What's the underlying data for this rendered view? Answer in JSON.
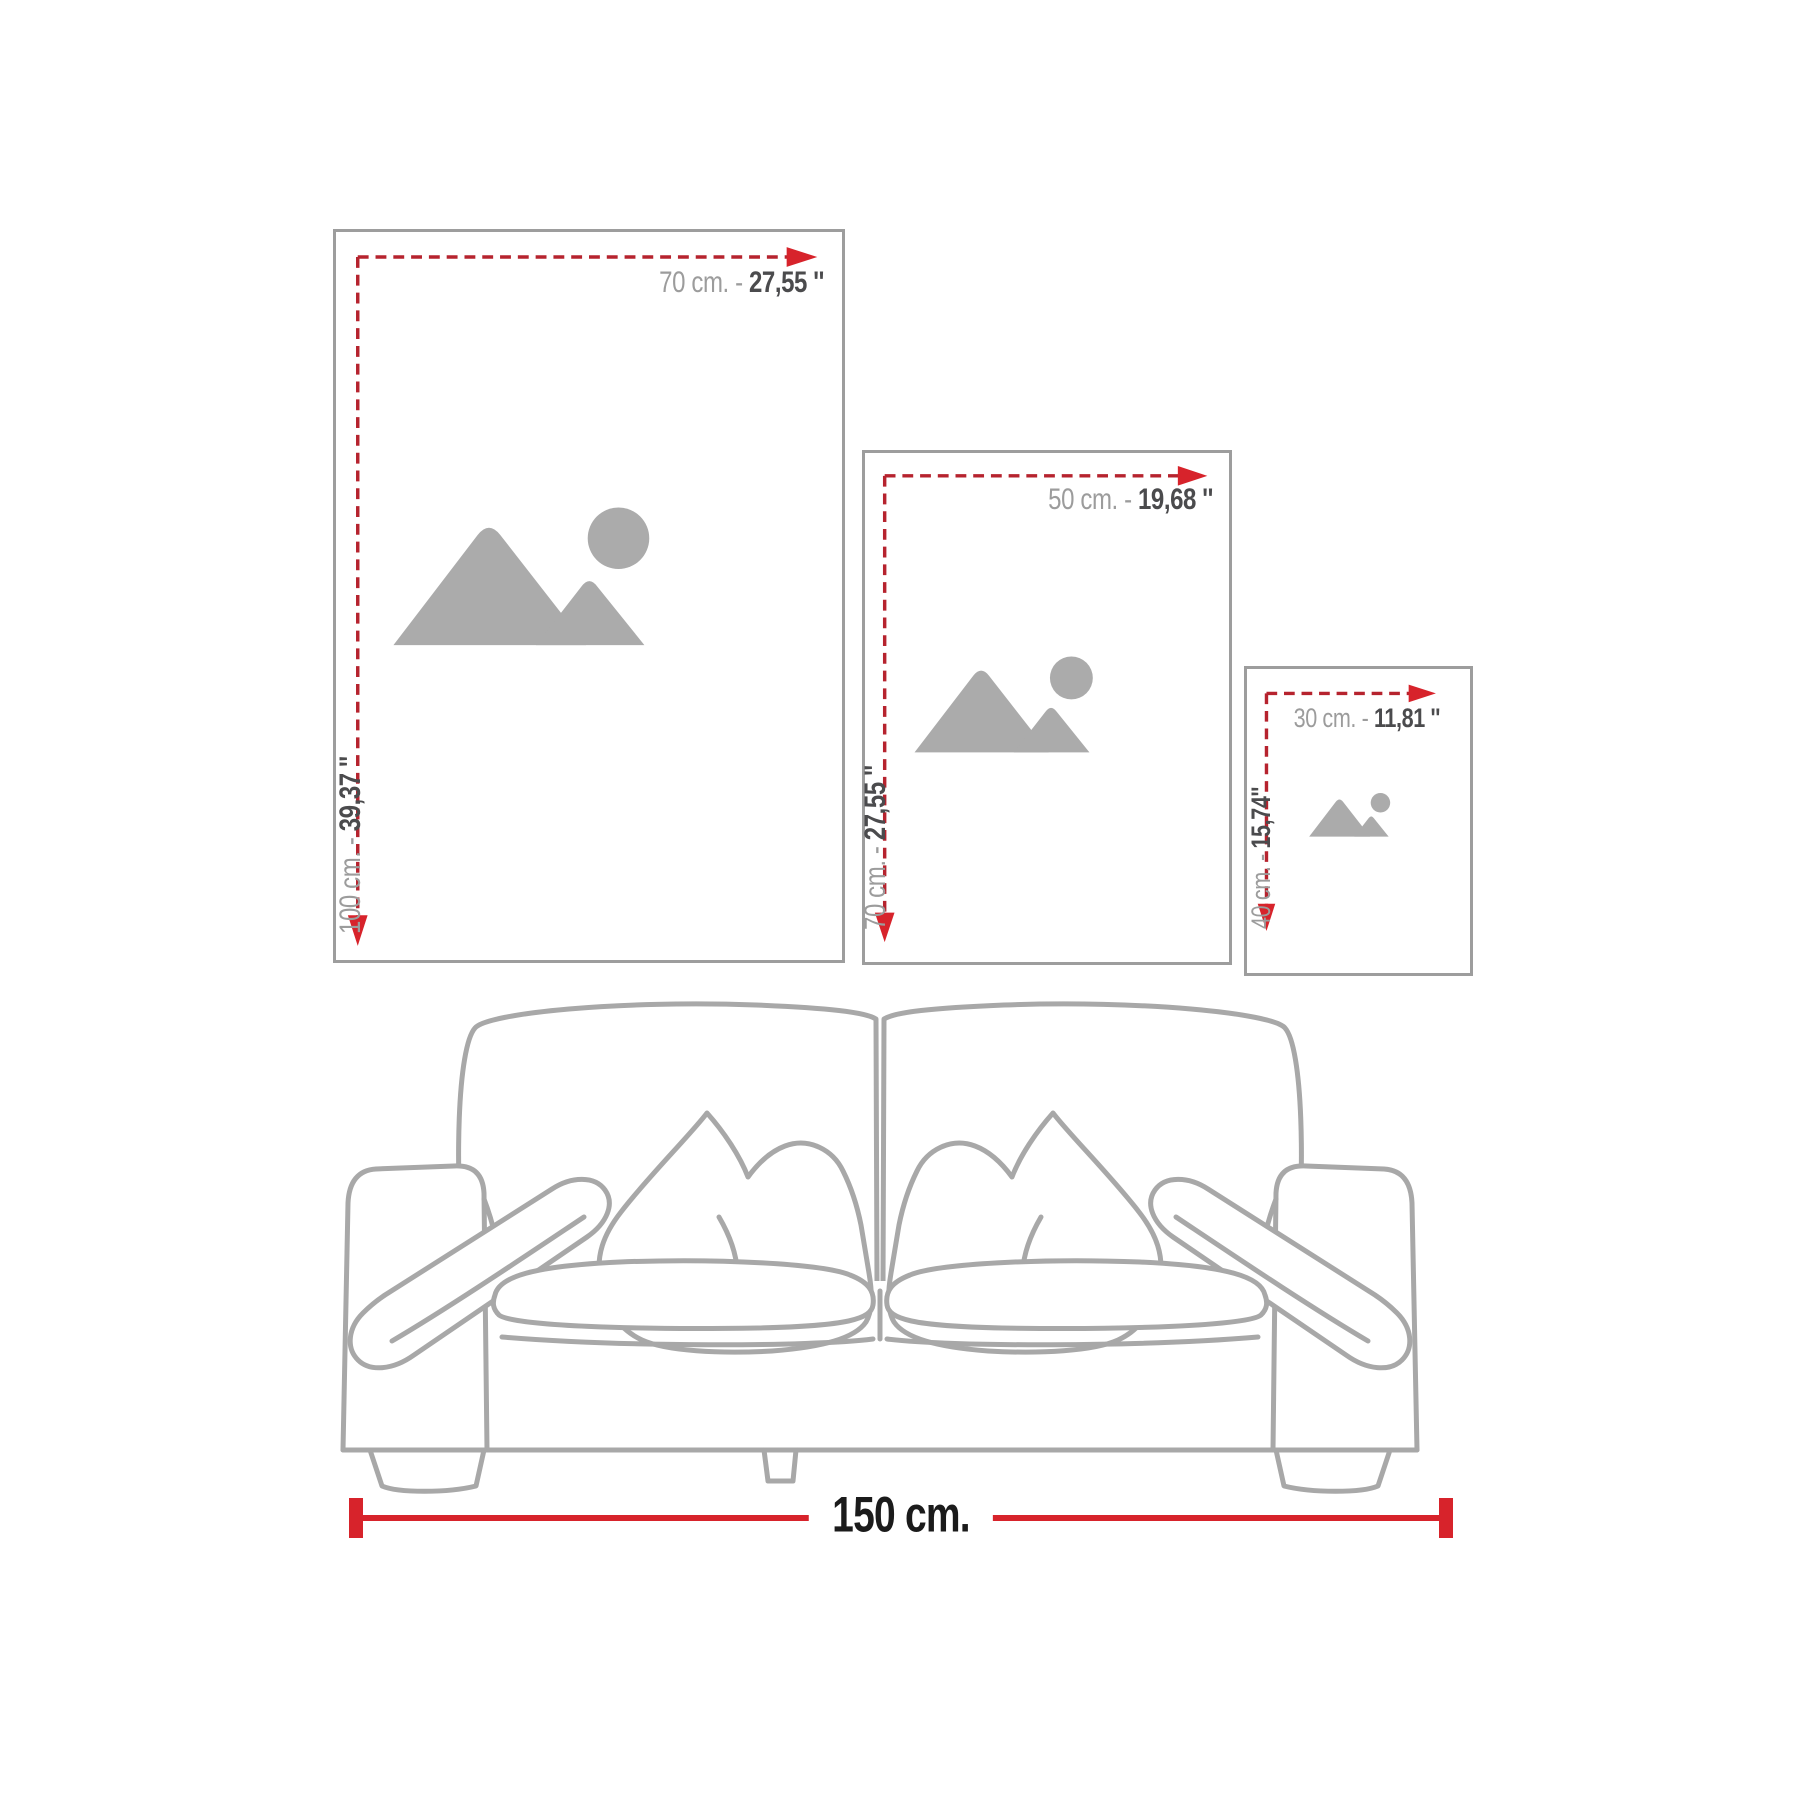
{
  "infographic": {
    "title": "wall-art size guide with sofa scale reference"
  },
  "frames": [
    {
      "name": "poster-70x100",
      "width": {
        "prefix": "70 cm. - ",
        "value": "27,55 ''"
      },
      "height": {
        "prefix": "100 cm. - ",
        "value": "39,37 ''"
      }
    },
    {
      "name": "poster-50x70",
      "width": {
        "prefix": "50 cm. - ",
        "value": "19,68 ''"
      },
      "height": {
        "prefix": "70 cm. - ",
        "value": "27,55 ''"
      }
    },
    {
      "name": "poster-30x40",
      "width": {
        "prefix": "30 cm. - ",
        "value": "11,81 ''"
      },
      "height": {
        "prefix": "40 cm. - ",
        "value": "15,74''"
      }
    }
  ],
  "sofa": {
    "width_label": "150 cm."
  },
  "colors": {
    "dash_red": "#b6232e",
    "arrow_red": "#d7232b",
    "solid_red": "#d7232b",
    "frame_border": "#9d9d9d",
    "label_light": "#9c9c9c",
    "label_dark": "#4b4b4d",
    "sofa_line": "#a8a8a8",
    "icon_gray": "#ababab",
    "bottom_label_black": "#1b1b1b"
  }
}
